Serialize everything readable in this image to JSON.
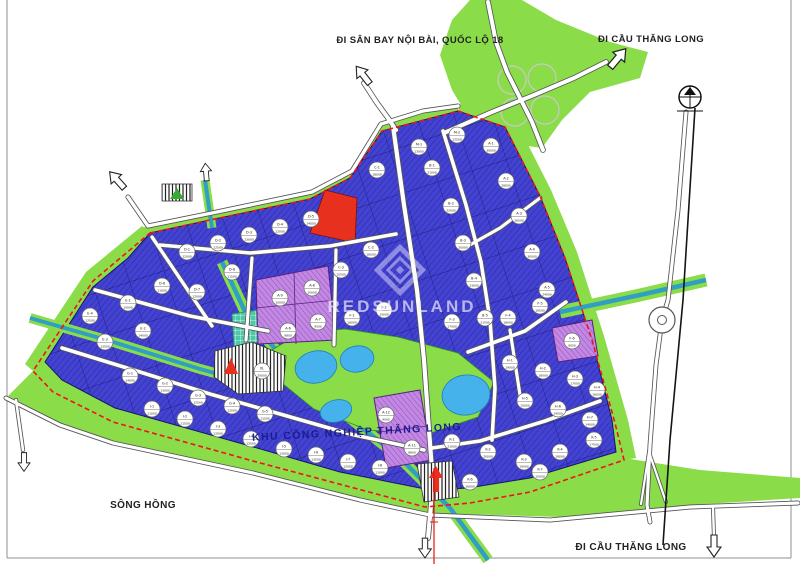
{
  "labels": {
    "top_left_road": "ĐI SÂN BAY NỘI BÀI, QUỐC LỘ 18",
    "top_right_road": "ĐI CẦU THĂNG LONG",
    "bottom_right_road": "ĐI CẦU THĂNG LONG",
    "river": "SÔNG HỒNG",
    "park_name": "KHU CÔNG NGHIỆP THĂNG LONG",
    "watermark": "REDSUNLAND"
  },
  "colors": {
    "parcel-blue": "#4443d0",
    "parcel-hatch": "#2e2dbb",
    "parcel-border": "#15156a",
    "purple": "#c289e2",
    "purple-hatch": "#9b50c6",
    "red-parcel": "#e8301f",
    "green": "#8bdc49",
    "green-dark": "#2f8f1f",
    "water": "#45b2ec",
    "canal": "#2f9fc4",
    "boundary-red": "#f01414",
    "road-casing": "#555555",
    "text": "#222222",
    "park-label": "#18188e",
    "watermark": "rgba(240,238,255,0.68)"
  },
  "map": {
    "parcels": [
      {
        "id": "A-1",
        "area": "30000",
        "x": 491,
        "y": 146
      },
      {
        "id": "A-2",
        "area": "28000",
        "x": 506,
        "y": 181
      },
      {
        "id": "A-3",
        "area": "26500",
        "x": 519,
        "y": 216
      },
      {
        "id": "A-4",
        "area": "30000",
        "x": 532,
        "y": 252
      },
      {
        "id": "A-5",
        "area": "24000",
        "x": 547,
        "y": 290
      },
      {
        "id": "M-1",
        "area": "13000",
        "x": 419,
        "y": 147
      },
      {
        "id": "M-2",
        "area": "12500",
        "x": 457,
        "y": 135
      },
      {
        "id": "B-1",
        "area": "21000",
        "x": 432,
        "y": 168
      },
      {
        "id": "B-2",
        "area": "22000",
        "x": 451,
        "y": 206
      },
      {
        "id": "B-3",
        "area": "20000",
        "x": 463,
        "y": 243
      },
      {
        "id": "B-4",
        "area": "23000",
        "x": 474,
        "y": 281
      },
      {
        "id": "B-5",
        "area": "21500",
        "x": 485,
        "y": 318
      },
      {
        "id": "C-1",
        "area": "18000",
        "x": 377,
        "y": 170
      },
      {
        "id": "C-2",
        "area": "16000",
        "x": 371,
        "y": 250
      },
      {
        "id": "C-3",
        "area": "15500",
        "x": 341,
        "y": 270
      },
      {
        "id": "D-1",
        "area": "12000",
        "x": 187,
        "y": 252
      },
      {
        "id": "D-2",
        "area": "12500",
        "x": 218,
        "y": 243
      },
      {
        "id": "D-3",
        "area": "13000",
        "x": 249,
        "y": 235
      },
      {
        "id": "D-4",
        "area": "12000",
        "x": 280,
        "y": 227
      },
      {
        "id": "D-5",
        "area": "14000",
        "x": 311,
        "y": 219
      },
      {
        "id": "D-6",
        "area": "11000",
        "x": 162,
        "y": 286
      },
      {
        "id": "D-7",
        "area": "12000",
        "x": 197,
        "y": 292
      },
      {
        "id": "D-8",
        "area": "11500",
        "x": 232,
        "y": 272
      },
      {
        "id": "A-9",
        "area": "10000",
        "x": 280,
        "y": 298
      },
      {
        "id": "A-8",
        "area": "10000",
        "x": 312,
        "y": 288
      },
      {
        "id": "A-7",
        "area": "9500",
        "x": 318,
        "y": 322
      },
      {
        "id": "A-6",
        "area": "9800",
        "x": 288,
        "y": 331
      },
      {
        "id": "E-1",
        "area": "15000",
        "x": 128,
        "y": 303
      },
      {
        "id": "E-2",
        "area": "14000",
        "x": 143,
        "y": 331
      },
      {
        "id": "E-3",
        "area": "13500",
        "x": 105,
        "y": 342
      },
      {
        "id": "E-4",
        "area": "12500",
        "x": 90,
        "y": 316
      },
      {
        "id": "F-1",
        "area": "16000",
        "x": 352,
        "y": 318
      },
      {
        "id": "F-2",
        "area": "15000",
        "x": 384,
        "y": 310
      },
      {
        "id": "F-3",
        "area": "17000",
        "x": 452,
        "y": 322
      },
      {
        "id": "F-4",
        "area": "18000",
        "x": 508,
        "y": 318
      },
      {
        "id": "F-5",
        "area": "16500",
        "x": 540,
        "y": 306
      },
      {
        "id": "F-6",
        "area": "9000",
        "x": 572,
        "y": 341
      },
      {
        "id": "G-1",
        "area": "14000",
        "x": 130,
        "y": 376
      },
      {
        "id": "G-2",
        "area": "13000",
        "x": 165,
        "y": 386
      },
      {
        "id": "G-3",
        "area": "12500",
        "x": 198,
        "y": 398
      },
      {
        "id": "G-4",
        "area": "12000",
        "x": 232,
        "y": 406
      },
      {
        "id": "G-5",
        "area": "11500",
        "x": 265,
        "y": 414
      },
      {
        "id": "XL",
        "area": "20000",
        "x": 262,
        "y": 371
      },
      {
        "id": "H-1",
        "area": "19000",
        "x": 510,
        "y": 363
      },
      {
        "id": "H-2",
        "area": "18000",
        "x": 543,
        "y": 371
      },
      {
        "id": "H-3",
        "area": "17000",
        "x": 575,
        "y": 379
      },
      {
        "id": "H-4",
        "area": "16000",
        "x": 597,
        "y": 390
      },
      {
        "id": "H-5",
        "area": "15000",
        "x": 525,
        "y": 401
      },
      {
        "id": "H-6",
        "area": "14500",
        "x": 558,
        "y": 409
      },
      {
        "id": "H-7",
        "area": "14000",
        "x": 590,
        "y": 420
      },
      {
        "id": "I-1",
        "area": "11000",
        "x": 152,
        "y": 409
      },
      {
        "id": "I-2",
        "area": "11500",
        "x": 185,
        "y": 419
      },
      {
        "id": "I-3",
        "area": "12000",
        "x": 218,
        "y": 429
      },
      {
        "id": "I-4",
        "area": "12500",
        "x": 251,
        "y": 439
      },
      {
        "id": "I-5",
        "area": "13000",
        "x": 284,
        "y": 449
      },
      {
        "id": "I-6",
        "area": "13500",
        "x": 316,
        "y": 455
      },
      {
        "id": "I-7",
        "area": "12000",
        "x": 348,
        "y": 462
      },
      {
        "id": "I-8",
        "area": "11000",
        "x": 380,
        "y": 468
      },
      {
        "id": "K-1",
        "area": "21000",
        "x": 452,
        "y": 442
      },
      {
        "id": "K-2",
        "area": "20000",
        "x": 488,
        "y": 452
      },
      {
        "id": "K-3",
        "area": "19000",
        "x": 524,
        "y": 462
      },
      {
        "id": "K-4",
        "area": "18000",
        "x": 560,
        "y": 452
      },
      {
        "id": "K-5",
        "area": "17500",
        "x": 594,
        "y": 440
      },
      {
        "id": "K-6",
        "area": "16000",
        "x": 470,
        "y": 482
      },
      {
        "id": "K-7",
        "area": "15000",
        "x": 540,
        "y": 472
      },
      {
        "id": "A-12",
        "area": "9000",
        "x": 386,
        "y": 415
      },
      {
        "id": "A-11",
        "area": "8800",
        "x": 412,
        "y": 448
      }
    ],
    "arrows": [
      {
        "name": "arrow-northwest-icon",
        "x": 117,
        "y": 180,
        "rot": -42,
        "s": 1
      },
      {
        "name": "arrow-north-icon",
        "x": 206,
        "y": 172,
        "rot": -5,
        "s": 0.8
      },
      {
        "name": "arrow-airport-icon",
        "x": 363,
        "y": 75,
        "rot": -38,
        "s": 1
      },
      {
        "name": "arrow-bridge-north-icon",
        "x": 618,
        "y": 58,
        "rot": 40,
        "s": 1.1
      },
      {
        "name": "arrow-south-left-icon",
        "x": 24,
        "y": 462,
        "rot": 180,
        "s": 0.85
      },
      {
        "name": "arrow-south-center-icon",
        "x": 425,
        "y": 548,
        "rot": 180,
        "s": 0.9
      },
      {
        "name": "arrow-bridge-south-icon",
        "x": 714,
        "y": 546,
        "rot": 180,
        "s": 1
      }
    ]
  }
}
